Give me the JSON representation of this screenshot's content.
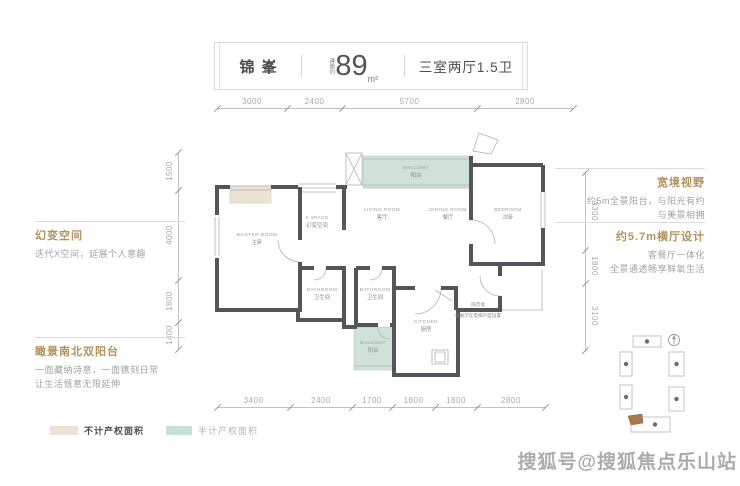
{
  "header": {
    "name": "锦峯",
    "area_prefix": "建面约",
    "area_value": "89",
    "area_unit": "m²",
    "layout": "三室两厅1.5卫"
  },
  "dimensions": {
    "top": [
      "3000",
      "2400",
      "5700",
      "2800"
    ],
    "bottom": [
      "3400",
      "2400",
      "1700",
      "1800",
      "1800",
      "2800"
    ],
    "left": [
      "1500",
      "4000",
      "1800",
      "1400"
    ],
    "right": [
      "3300",
      "1800",
      "3100"
    ]
  },
  "rooms": [
    {
      "en": "MASTER ROOM",
      "cn": "主卧"
    },
    {
      "en": "X SPACE",
      "cn": "幻变空间"
    },
    {
      "en": "LIVING ROOM",
      "cn": "客厅"
    },
    {
      "en": "DINING ROOM",
      "cn": "餐厅"
    },
    {
      "en": "BEDROOM",
      "cn": "次卧"
    },
    {
      "en": "BALCONY",
      "cn": "阳台"
    },
    {
      "en": "BATHROOM",
      "cn": "卫生间"
    },
    {
      "en": "BATHROOM",
      "cn": "卫生间"
    },
    {
      "en": "KITCHEN",
      "cn": "厨房"
    },
    {
      "en": "BALCONY",
      "cn": "阳台"
    }
  ],
  "plan_note": {
    "line1": "隔音墙",
    "line2": "仅展示在电梯户型设置"
  },
  "annotations": {
    "left_top": {
      "title": "幻变空间",
      "lines": [
        "迭代X空间，延展个人意趣"
      ]
    },
    "left_bottom": {
      "title": "瞰景南北双阳台",
      "lines": [
        "一面藏纳诗意，一面镌刻日常",
        "让生活惬意无限延伸"
      ]
    },
    "right_top": {
      "title": "宽境视野",
      "lines": [
        "约5m全景阳台，与阳光有约",
        "与美景相拥"
      ]
    },
    "right_bottom": {
      "title": "约5.7m横厅设计",
      "lines": [
        "客餐厅一体化",
        "全景通透畅享鲜氧生活"
      ]
    }
  },
  "legend": [
    {
      "label": "不计产权面积",
      "color": "#ece3d5"
    },
    {
      "label": "半计产权面积",
      "color": "#c9dfd3"
    }
  ],
  "watermark": "搜狐号@搜狐焦点乐山站",
  "colors": {
    "wall": "#54555a",
    "balcony_green": "#cfe2d7",
    "bay_beige": "#ece3d5",
    "accent_tan": "#b3925e",
    "highlight_brown": "#a6794e"
  }
}
